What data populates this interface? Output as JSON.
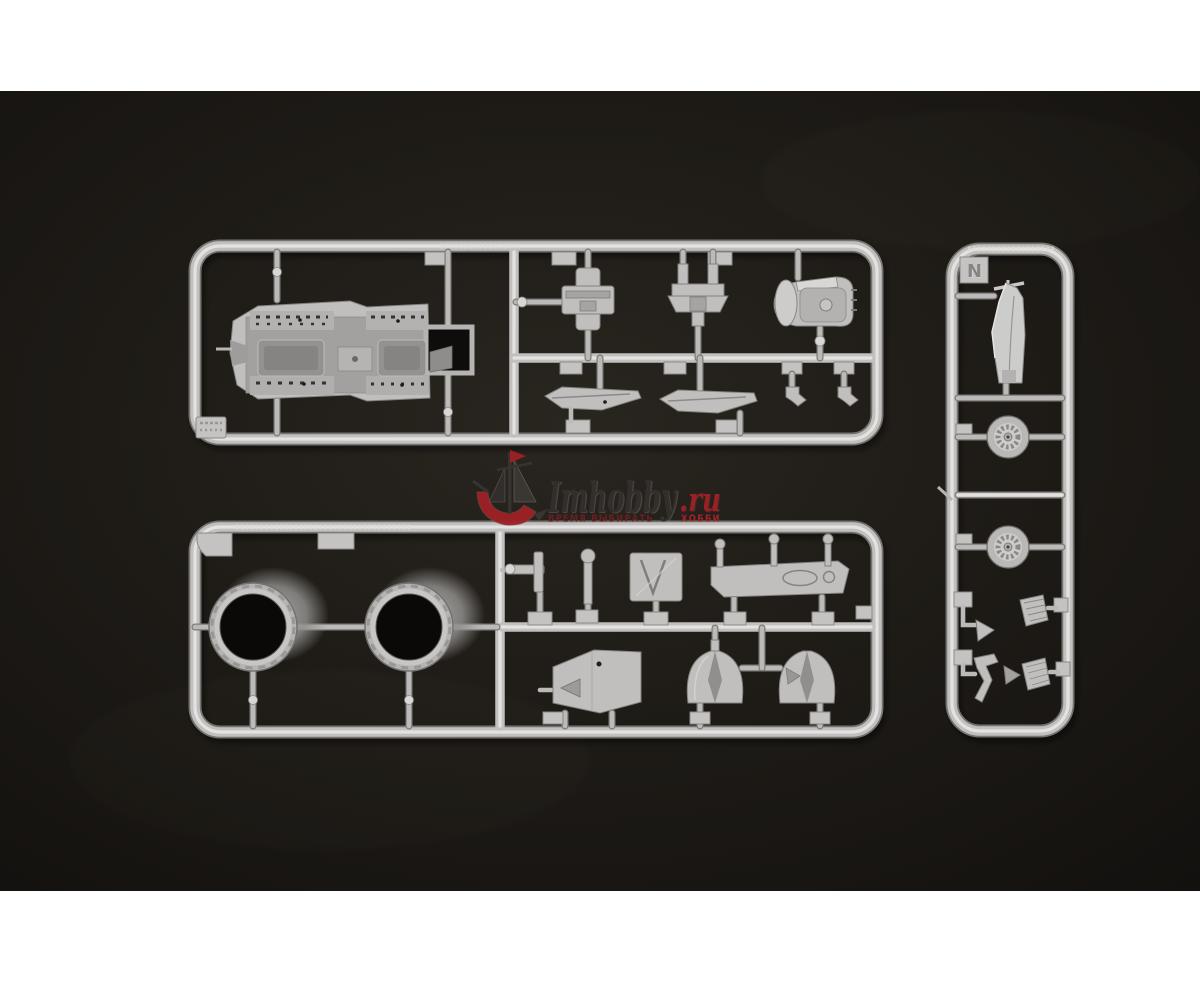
{
  "image": {
    "kind": "product-photo",
    "subject": "Plastic model kit sprues (runners) with molded parts on a dark background",
    "border_color": "#ffffff",
    "photo_background": "#1d1a18"
  },
  "watermark": {
    "brand": "Imhobby",
    "domain": ".ru",
    "slogan_left": "ВРЕМЯ ВЫБИРАТЬ",
    "slogan_right": "ХОББИ",
    "brand_color": "#332f2c",
    "accent_color": "#9e2127"
  },
  "sprues": {
    "runner_label": "N",
    "plastic_color": "#c6c5c3",
    "count": 3,
    "parts": {
      "sprue_a": "cockpit tub, brackets, cowl, splitter plates, hooks",
      "sprue_b": "engine duct rings, levers, panels, intake wedges",
      "sprue_c": "tail fin, two wheels, mesh screens, linkages"
    }
  }
}
